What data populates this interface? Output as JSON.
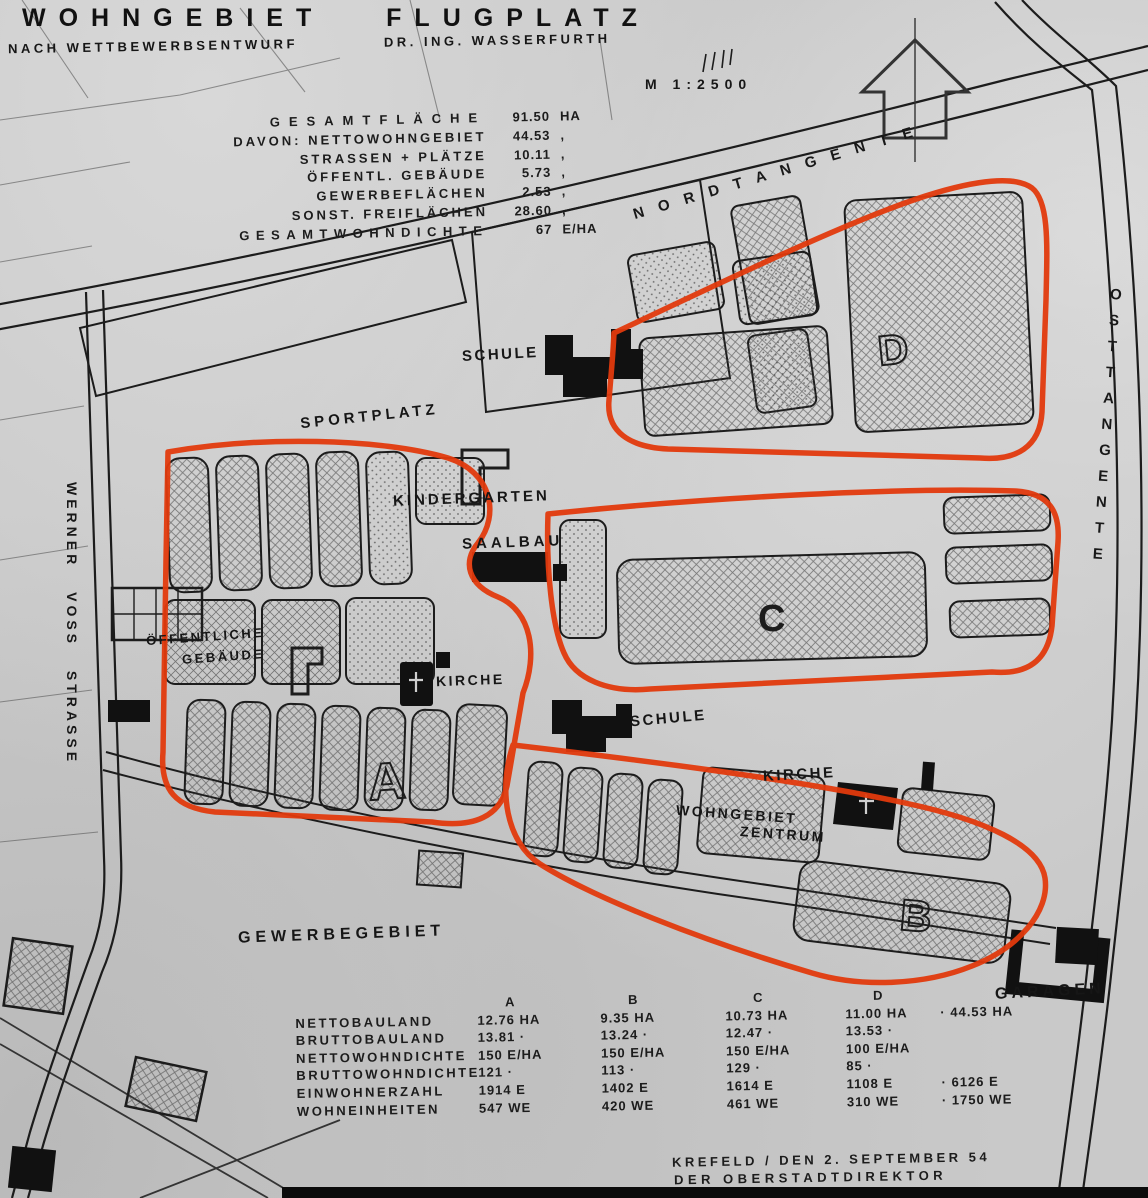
{
  "header": {
    "title": "WOHNGEBIET FLUGPLATZ",
    "subtitle_left": "NACH WETTBEWERBSENTWURF",
    "subtitle_right": "DR. ING. WASSERFURTH",
    "scale": "M 1:2500"
  },
  "area_stats": {
    "rows": [
      {
        "label": "GESAMTFLÄCHE",
        "value": "91.50",
        "unit": "HA"
      },
      {
        "label": "DAVON: NETTOWOHNGEBIET",
        "value": "44.53",
        "unit": ","
      },
      {
        "label": "STRASSEN + PLÄTZE",
        "value": "10.11",
        "unit": ","
      },
      {
        "label": "ÖFFENTL. GEBÄUDE",
        "value": "5.73",
        "unit": ","
      },
      {
        "label": "GEWERBEFLÄCHEN",
        "value": "2.53",
        "unit": ","
      },
      {
        "label": "SONST. FREIFLÄCHEN",
        "value": "28.60",
        "unit": ","
      },
      {
        "label": "GESAMTWOHNDICHTE",
        "value": "67",
        "unit": "E/HA"
      }
    ]
  },
  "streets": {
    "nordtangente": "NORDTANGENTE",
    "osttangente": "OSTTANGENTE",
    "werner_voss": "WERNER VOSS STRASSE"
  },
  "map_labels": {
    "schule_top": "SCHULE",
    "sportplatz": "SPORTPLATZ",
    "kindergarten": "KINDERGARTEN",
    "saalbau": "SAALBAU",
    "oeffentliche": "ÖFFENTLICHE",
    "gebaeude": "GEBÄUDE",
    "kirche_left": "KIRCHE",
    "schule_mid": "SCHULE",
    "kirche_right": "KIRCHE",
    "wohngebiet": "WOHNGEBIET",
    "zentrum": "ZENTRUM",
    "gewerbegebiet": "GEWERBEGEBIET",
    "garagen": "GARAGEN"
  },
  "districts": {
    "a": "A",
    "b": "B",
    "c": "C",
    "d": "D"
  },
  "bottom_table": {
    "columns": [
      "A",
      "B",
      "C",
      "D"
    ],
    "rows": [
      {
        "label": "NETTOBAULAND",
        "a": "12.76 HA",
        "b": "9.35 HA",
        "c": "10.73 HA",
        "d": "11.00 HA",
        "total": "· 44.53 HA"
      },
      {
        "label": "BRUTTOBAULAND",
        "a": "13.81 ·",
        "b": "13.24 ·",
        "c": "12.47 ·",
        "d": "13.53 ·",
        "total": ""
      },
      {
        "label": "NETTOWOHNDICHTE",
        "a": "150 E/HA",
        "b": "150 E/HA",
        "c": "150 E/HA",
        "d": "100 E/HA",
        "total": ""
      },
      {
        "label": "BRUTTOWOHNDICHTE",
        "a": "121 ·",
        "b": "113 ·",
        "c": "129 ·",
        "d": "85 ·",
        "total": ""
      },
      {
        "label": "EINWOHNERZAHL",
        "a": "1914 E",
        "b": "1402 E",
        "c": "1614 E",
        "d": "1108 E",
        "total": "· 6126 E"
      },
      {
        "label": "WOHNEINHEITEN",
        "a": "547 WE",
        "b": "420 WE",
        "c": "461 WE",
        "d": "310 WE",
        "total": "· 1750 WE"
      }
    ]
  },
  "signature": {
    "line1": "KREFELD / DEN 2. SEPTEMBER 54",
    "line2": "DER OBERSTADTDIREKTOR"
  },
  "colors": {
    "red_outline": "#e23a0d",
    "ink": "#1c1c1c",
    "paper": "#c9c9c9"
  }
}
